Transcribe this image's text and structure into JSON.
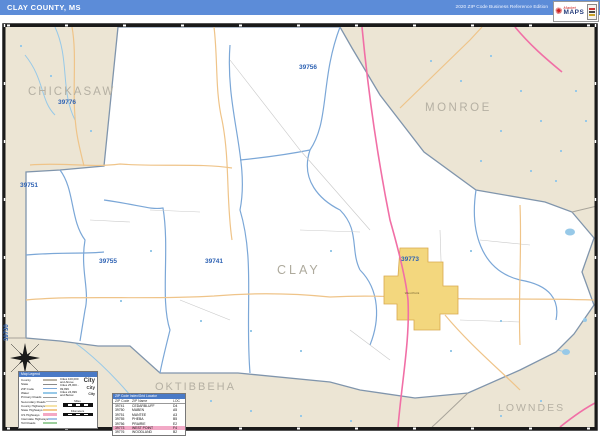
{
  "header": {
    "title": "CLAY COUNTY, MS",
    "edition": "2020 ZIP Code Business Reference Edition"
  },
  "logo": {
    "market": "Market",
    "maps": "MAPS"
  },
  "map": {
    "county_labels": {
      "chickasaw": "CHICKASAW",
      "monroe": "MONROE",
      "clay": "CLAY",
      "oktibbeha": "OKTIBBEHA",
      "lowndes": "LOWNDES"
    },
    "zip_labels": {
      "z39776": "39776",
      "z39756": "39756",
      "z39751": "39751",
      "z39755": "39755",
      "z39741": "39741",
      "z39773": "39773",
      "z39730": "39730"
    },
    "city_label": "West Point"
  },
  "legend": {
    "title": "Map Legend",
    "items": [
      {
        "label": "County"
      },
      {
        "label": "State"
      },
      {
        "label": "ZIP Code"
      },
      {
        "label": "Water"
      },
      {
        "label": "Primary Roads"
      },
      {
        "label": "Secondary Roads"
      },
      {
        "label": "County Highways"
      },
      {
        "label": "State Highways"
      },
      {
        "label": "US Highways"
      },
      {
        "label": "Interstate Highways"
      },
      {
        "label": "Toll Roads"
      }
    ],
    "cities": [
      {
        "label": "Cities 100,000 and Above",
        "sample": "City"
      },
      {
        "label": "Cities 25,000 - 99,999",
        "sample": "City"
      },
      {
        "label": "Cities 24,999 and Below",
        "sample": "City"
      }
    ],
    "scale": {
      "miles": "Miles",
      "kilometers": "Kilometers"
    }
  },
  "zip_table": {
    "title": "ZIP Code Index/Grid Locator",
    "columns": [
      "ZIP Code",
      "ZIP Name",
      "LOC"
    ],
    "rows": [
      {
        "zip": "39741",
        "name": "CEDARBLUFF",
        "loc": "D4"
      },
      {
        "zip": "39750",
        "name": "MABEN",
        "loc": "A5"
      },
      {
        "zip": "39751",
        "name": "MANTEE",
        "loc": "A3"
      },
      {
        "zip": "39755",
        "name": "PHEBA",
        "loc": "B5"
      },
      {
        "zip": "39756",
        "name": "PRAIRIE",
        "loc": "E2"
      },
      {
        "zip": "39773",
        "name": "WEST POINT",
        "loc": "F4"
      },
      {
        "zip": "39776",
        "name": "WOODLAND",
        "loc": "B2"
      }
    ],
    "highlight_zip": "39773"
  },
  "colors": {
    "header_blue": "#5c8cd8",
    "panel_blue": "#4a7ac6",
    "map_background": "#ece5d4",
    "county_fill": "#ffffff",
    "county_border": "#8095ac",
    "zip_boundary": "#7ba7d7",
    "zip_label": "#2f63b4",
    "county_label": "#b5b0a3",
    "road_tan": "#efc489",
    "highway_pink": "#f16fa6",
    "water_blue": "#97c9e8",
    "city_fill": "#f3d77e",
    "highlight_pink": "#f2a9c6"
  }
}
